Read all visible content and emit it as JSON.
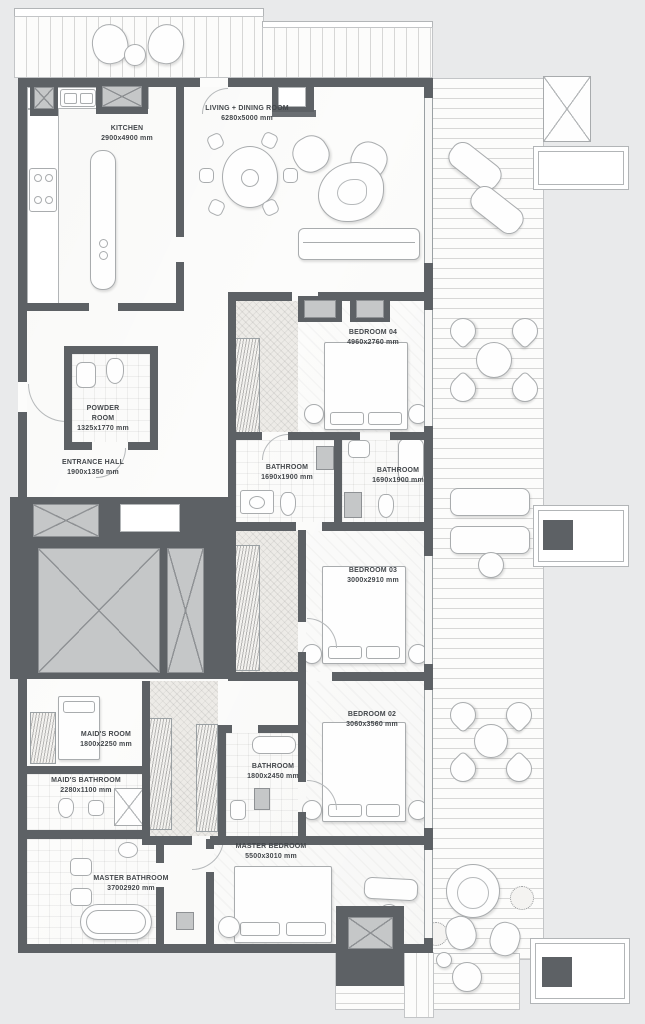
{
  "plan": {
    "rooms": {
      "kitchen": {
        "name": "KITCHEN",
        "dims": "2900x4900 mm"
      },
      "living_dining": {
        "name": "LIVING + DINING ROOM",
        "dims": "6280x5000 mm"
      },
      "bedroom04": {
        "name": "BEDROOM 04",
        "dims": "4960x2760 mm"
      },
      "powder_room": {
        "name": "POWDER ROOM",
        "dims": "1325x1770 mm"
      },
      "entrance_hall": {
        "name": "ENTRANCE HALL",
        "dims": "1900x1350 mm"
      },
      "bathroom_a": {
        "name": "BATHROOM",
        "dims": "1690x1900 mm"
      },
      "bathroom_b": {
        "name": "BATHROOM",
        "dims": "1690x1900 mm"
      },
      "bedroom03": {
        "name": "BEDROOM 03",
        "dims": "3000x2910 mm"
      },
      "bedroom02": {
        "name": "BEDROOM 02",
        "dims": "3060x3560 mm"
      },
      "maids_room": {
        "name": "MAID'S ROOM",
        "dims": "1800x2250 mm"
      },
      "maids_bathroom": {
        "name": "MAID'S BATHROOM",
        "dims": "2280x1100 mm"
      },
      "bathroom_c": {
        "name": "BATHROOM",
        "dims": "1800x2450 mm"
      },
      "master_bedroom": {
        "name": "MASTER BEDROOM",
        "dims": "5500x3010 mm"
      },
      "master_bathroom": {
        "name": "MASTER BATHROOM",
        "dims": "37002920 mm"
      }
    },
    "colors": {
      "wall": "#5d6165",
      "shaft_fill": "#c5c7c8",
      "planter_block": "#6d7175",
      "background": "#e9eaeb"
    }
  }
}
